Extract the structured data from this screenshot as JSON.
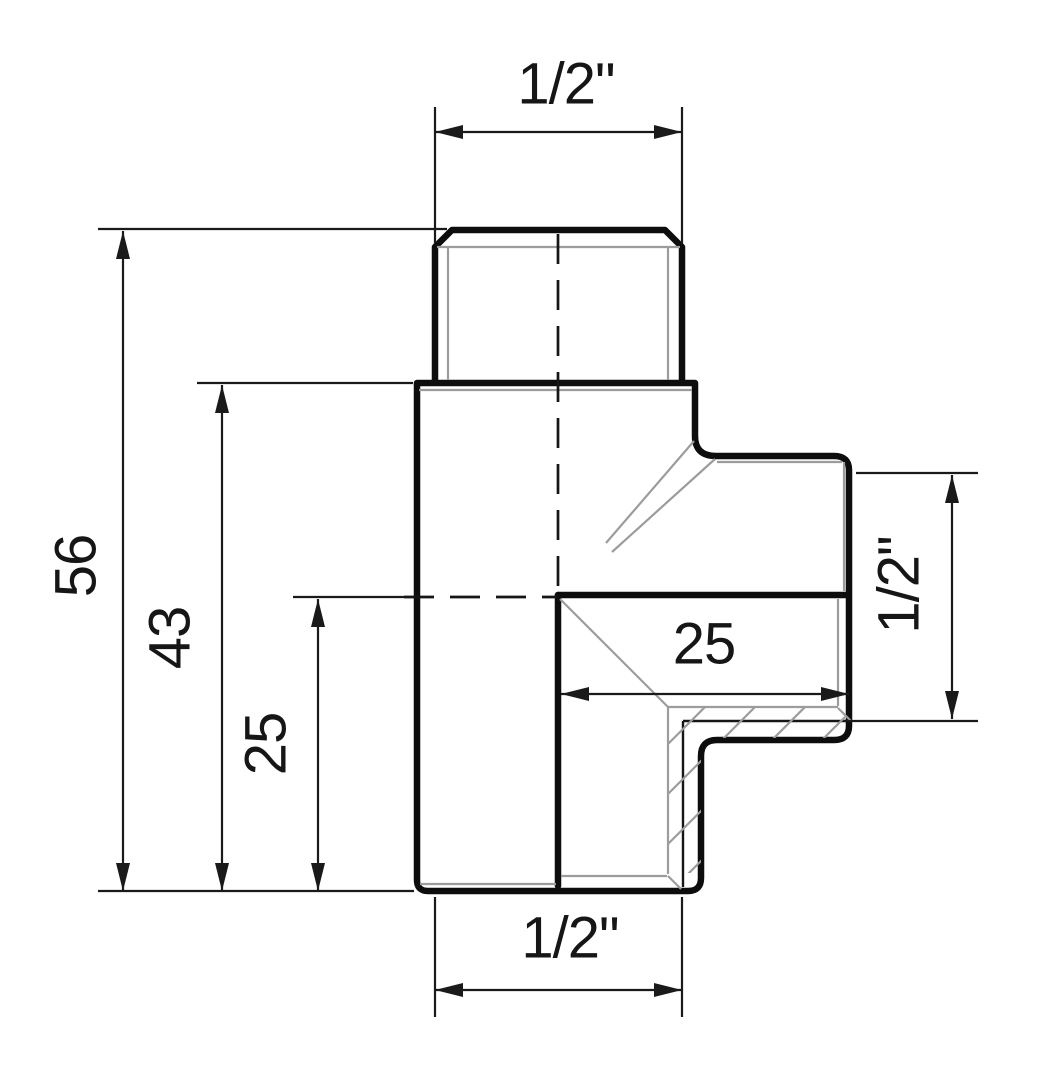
{
  "drawing": {
    "title": "Pipe tee fitting — dimensioned half-section drawing",
    "type": "technical-drawing",
    "background_color": "#ffffff",
    "outline_color": "#0d0d0d",
    "thin_detail_color": "#9c9c9c",
    "dimension_color": "#1a1a1a",
    "dimensions": {
      "top_thread": {
        "label": "1/2\"",
        "meaning": "male thread size, top port"
      },
      "overall_height": {
        "label": "56",
        "meaning": "overall height"
      },
      "body_height": {
        "label": "43",
        "meaning": "body height without male thread"
      },
      "center_to_bottom": {
        "label": "25",
        "meaning": "branch axis to bottom face"
      },
      "center_to_branch_face": {
        "label": "25",
        "meaning": "vertical axis to branch end face"
      },
      "branch_thread": {
        "label": "1/2\"",
        "meaning": "female thread size, side branch"
      },
      "bottom_thread": {
        "label": "1/2\"",
        "meaning": "female thread size, bottom port"
      }
    }
  }
}
